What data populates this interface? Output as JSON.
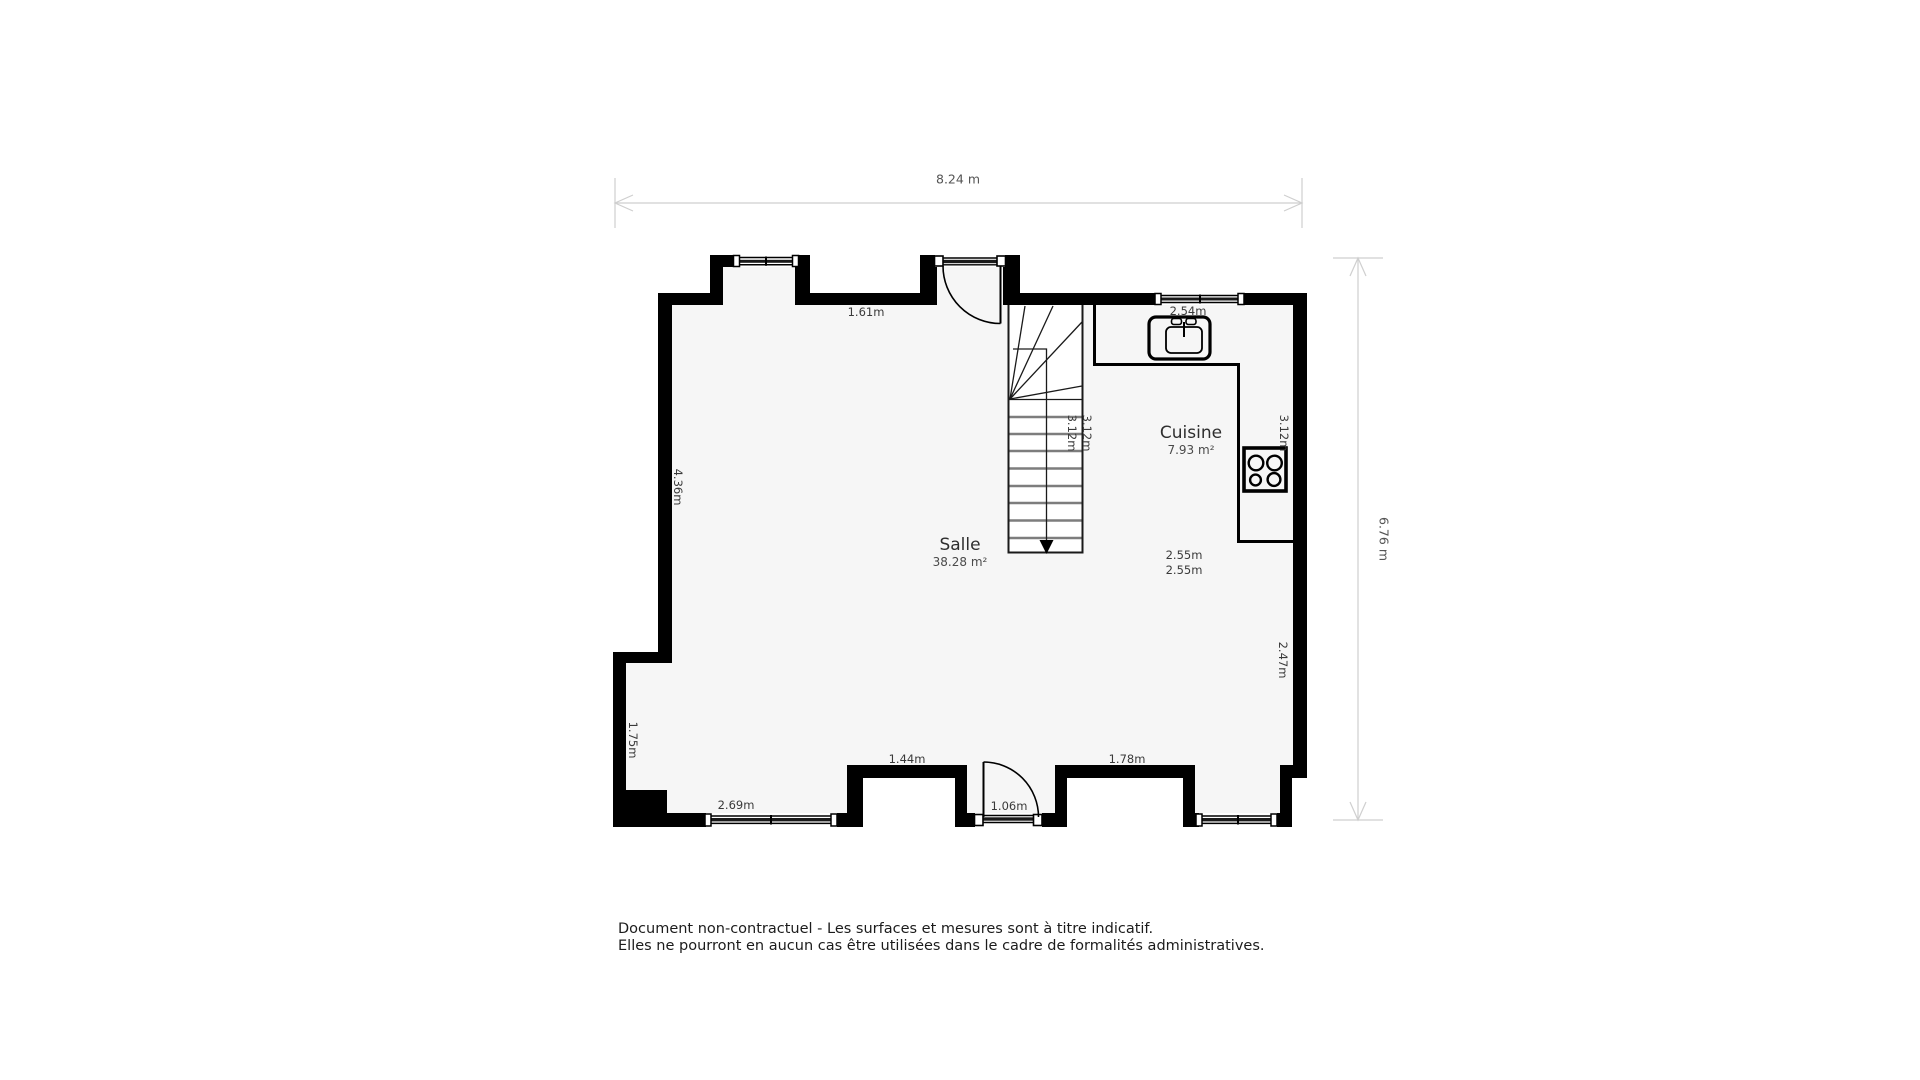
{
  "dimensions": {
    "overall_width": "8.24 m",
    "overall_height": "6.76 m"
  },
  "rooms": {
    "salle": {
      "name": "Salle",
      "area": "38.28 m²"
    },
    "cuisine": {
      "name": "Cuisine",
      "area": "7.93 m²"
    }
  },
  "measurements": {
    "top_wall_between_openings": "1.61m",
    "kitchen_top_wall": "2.54m",
    "kitchen_width_a": "2.55m",
    "kitchen_width_b": "2.55m",
    "stair_run_a": "3.12m",
    "stair_run_b": "3.12m",
    "kitchen_right_wall": "3.12m",
    "right_wall_lower": "2.47m",
    "left_wall": "4.36m",
    "left_wall_lower": "1.75m",
    "bottom_window_wall": "2.69m",
    "bottom_wall_left": "1.44m",
    "bottom_door": "1.06m",
    "bottom_wall_right": "1.78m"
  },
  "disclaimer": {
    "line1": "Document non-contractuel - Les surfaces et mesures sont à titre indicatif.",
    "line2": "Elles ne pourront en aucun cas être utilisées dans le cadre de formalités administratives."
  },
  "colors": {
    "wall": "#000000",
    "floor": "#f6f6f6",
    "dimension_line": "#cfcfcf",
    "label_text": "#3a3a3a"
  }
}
